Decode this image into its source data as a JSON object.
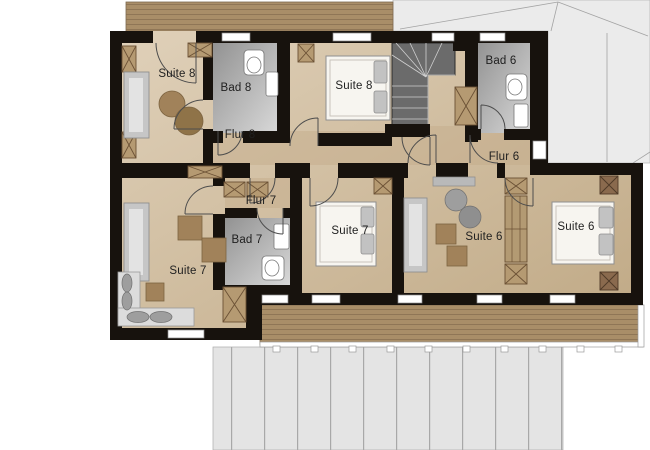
{
  "plan": {
    "rooms": [
      {
        "id": "suite-8-living",
        "label": "Suite 8",
        "x": 177,
        "y": 74
      },
      {
        "id": "bad-8",
        "label": "Bad 8",
        "x": 236,
        "y": 88
      },
      {
        "id": "flur-8",
        "label": "Flur 8",
        "x": 240,
        "y": 135
      },
      {
        "id": "suite-8-bedroom",
        "label": "Suite 8",
        "x": 354,
        "y": 86
      },
      {
        "id": "bad-6",
        "label": "Bad 6",
        "x": 501,
        "y": 61
      },
      {
        "id": "flur-6",
        "label": "Flur 6",
        "x": 504,
        "y": 157
      },
      {
        "id": "flur-7",
        "label": "Flur 7",
        "x": 261,
        "y": 201
      },
      {
        "id": "bad-7",
        "label": "Bad 7",
        "x": 247,
        "y": 240
      },
      {
        "id": "suite-7-living",
        "label": "Suite 7",
        "x": 188,
        "y": 271
      },
      {
        "id": "suite-7-bedroom",
        "label": "Suite 7",
        "x": 350,
        "y": 231
      },
      {
        "id": "suite-6-living",
        "label": "Suite 6",
        "x": 484,
        "y": 237
      },
      {
        "id": "suite-6-bedroom",
        "label": "Suite 6",
        "x": 576,
        "y": 227
      }
    ],
    "colors": {
      "wall": "#17120d",
      "floor": "#d6c3a6",
      "roof": "#ebebeb",
      "wood": "#a98e68",
      "bath": "#b5b5b5",
      "label": "#1f1f1f",
      "furniture": "#a1825a",
      "stairs": "#6b6b6b"
    }
  }
}
